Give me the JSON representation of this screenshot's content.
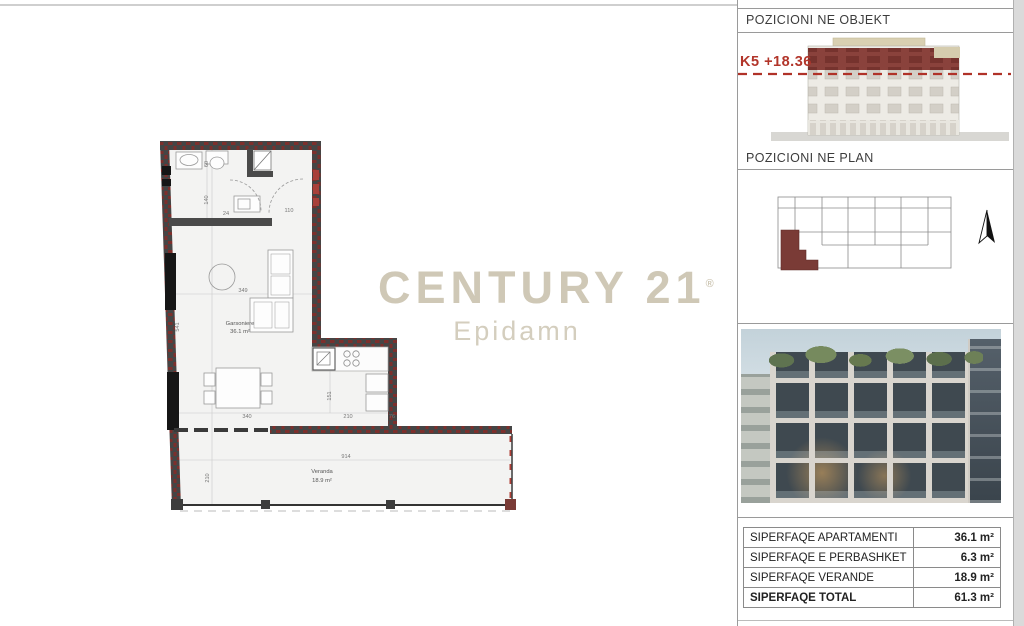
{
  "logo": {
    "line1": "CENTURY 21",
    "registered": "®",
    "line2": "Epidamn"
  },
  "floorplan": {
    "room1_name": "Garsoniere",
    "room1_area": "36.1 m²",
    "room2_name": "Veranda",
    "room2_area": "18.9 m²",
    "dims": {
      "d60": "60",
      "d140": "140",
      "d24": "24",
      "d110": "110",
      "d349": "349",
      "d541": "541",
      "d340": "340",
      "d151": "151",
      "d210a": "210",
      "d76": "76",
      "d914": "914",
      "d210b": "210"
    }
  },
  "sidebar": {
    "section_object": {
      "title": "POZICIONI NE OBJEKT",
      "level_label": "K5 +18.36"
    },
    "section_plan": {
      "title": "POZICIONI NE PLAN"
    },
    "table": {
      "rows": [
        {
          "label": "SIPERFAQE APARTAMENTI",
          "value": "36.1 m²"
        },
        {
          "label": "SIPERFAQE E PERBASHKET",
          "value": "6.3 m²"
        },
        {
          "label": "SIPERFAQE VERANDE",
          "value": "18.9 m²"
        },
        {
          "label": "SIPERFAQE TOTAL",
          "value": "61.3 m²"
        }
      ]
    }
  },
  "colors": {
    "wall_dark": "#454545",
    "hatch_red": "#7d2f2c",
    "unit_highlight": "#7a3b36",
    "level_red": "#b2352a",
    "logo_beige": "#cfc8b6"
  }
}
